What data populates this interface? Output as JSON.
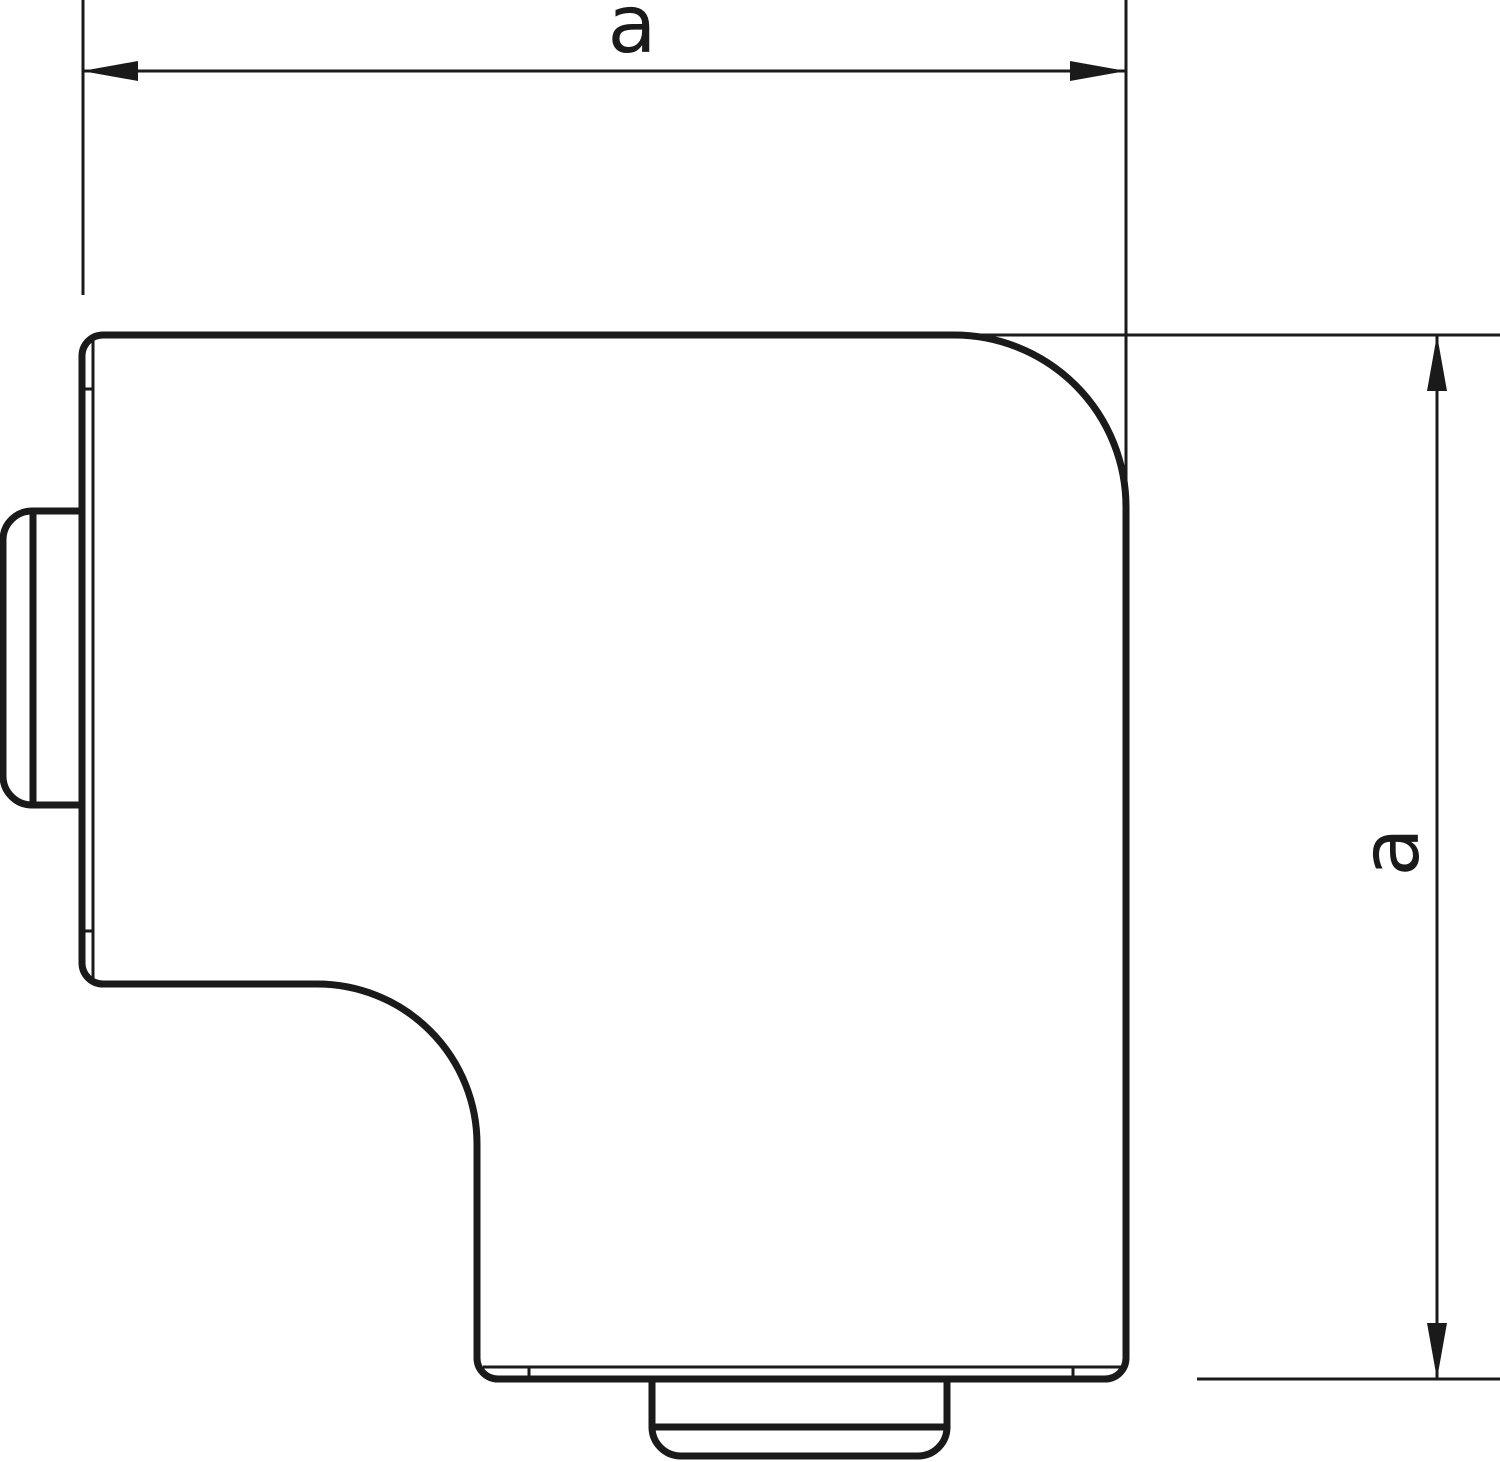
{
  "diagram": {
    "kind": "technical-dimension-drawing",
    "background_color": "#ffffff",
    "line_color": "#1a1a1a",
    "dimensions": {
      "horizontal": {
        "label": "a",
        "orientation": "horizontal",
        "position": "top"
      },
      "vertical": {
        "label": "a",
        "orientation": "vertical",
        "position": "right"
      }
    }
  }
}
